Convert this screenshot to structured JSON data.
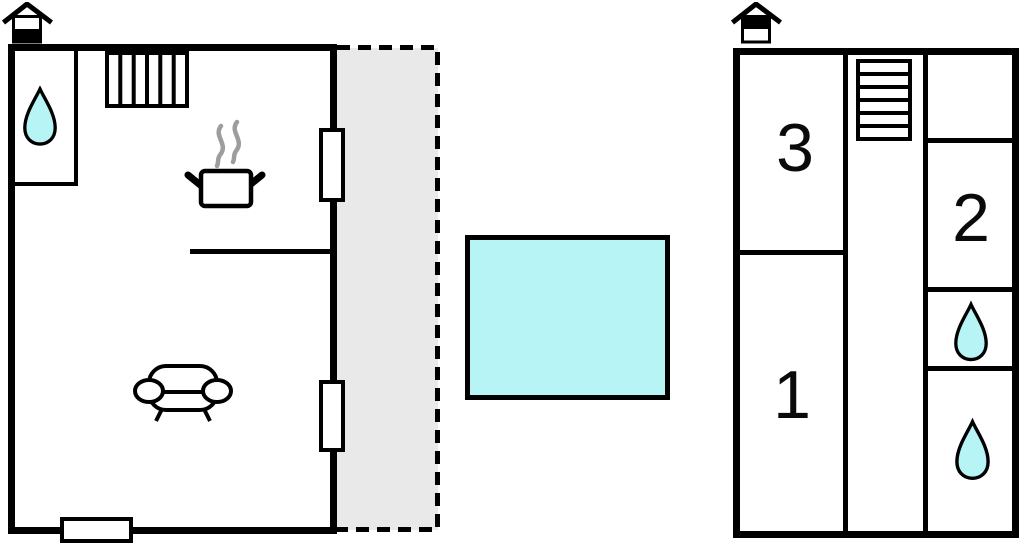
{
  "colors": {
    "wall": "#000000",
    "water": "#b6f4f6",
    "terrace": "#e9e9e9",
    "steam": "#9d9d9d",
    "background": "#ffffff"
  },
  "left_plan": {
    "house_icon": "house-ground-floor-icon",
    "icons": {
      "bathroom": "water-drop-icon",
      "stairs": "stairs-icon",
      "kitchen": "cooking-pot-icon",
      "living_room": "sofa-icon"
    },
    "window_count": 3,
    "terrace_outline": "dashed"
  },
  "pool": {
    "icon": "pool-rectangle",
    "fill": "#b6f4f6"
  },
  "right_plan": {
    "house_icon": "house-upper-floor-icon",
    "rooms": [
      {
        "label": "3"
      },
      {
        "label": "1"
      },
      {
        "label": "2"
      }
    ],
    "icons": {
      "stairs": "stairs-icon",
      "bathroom_upper": "water-drop-icon",
      "bathroom_lower": "water-drop-icon"
    }
  }
}
